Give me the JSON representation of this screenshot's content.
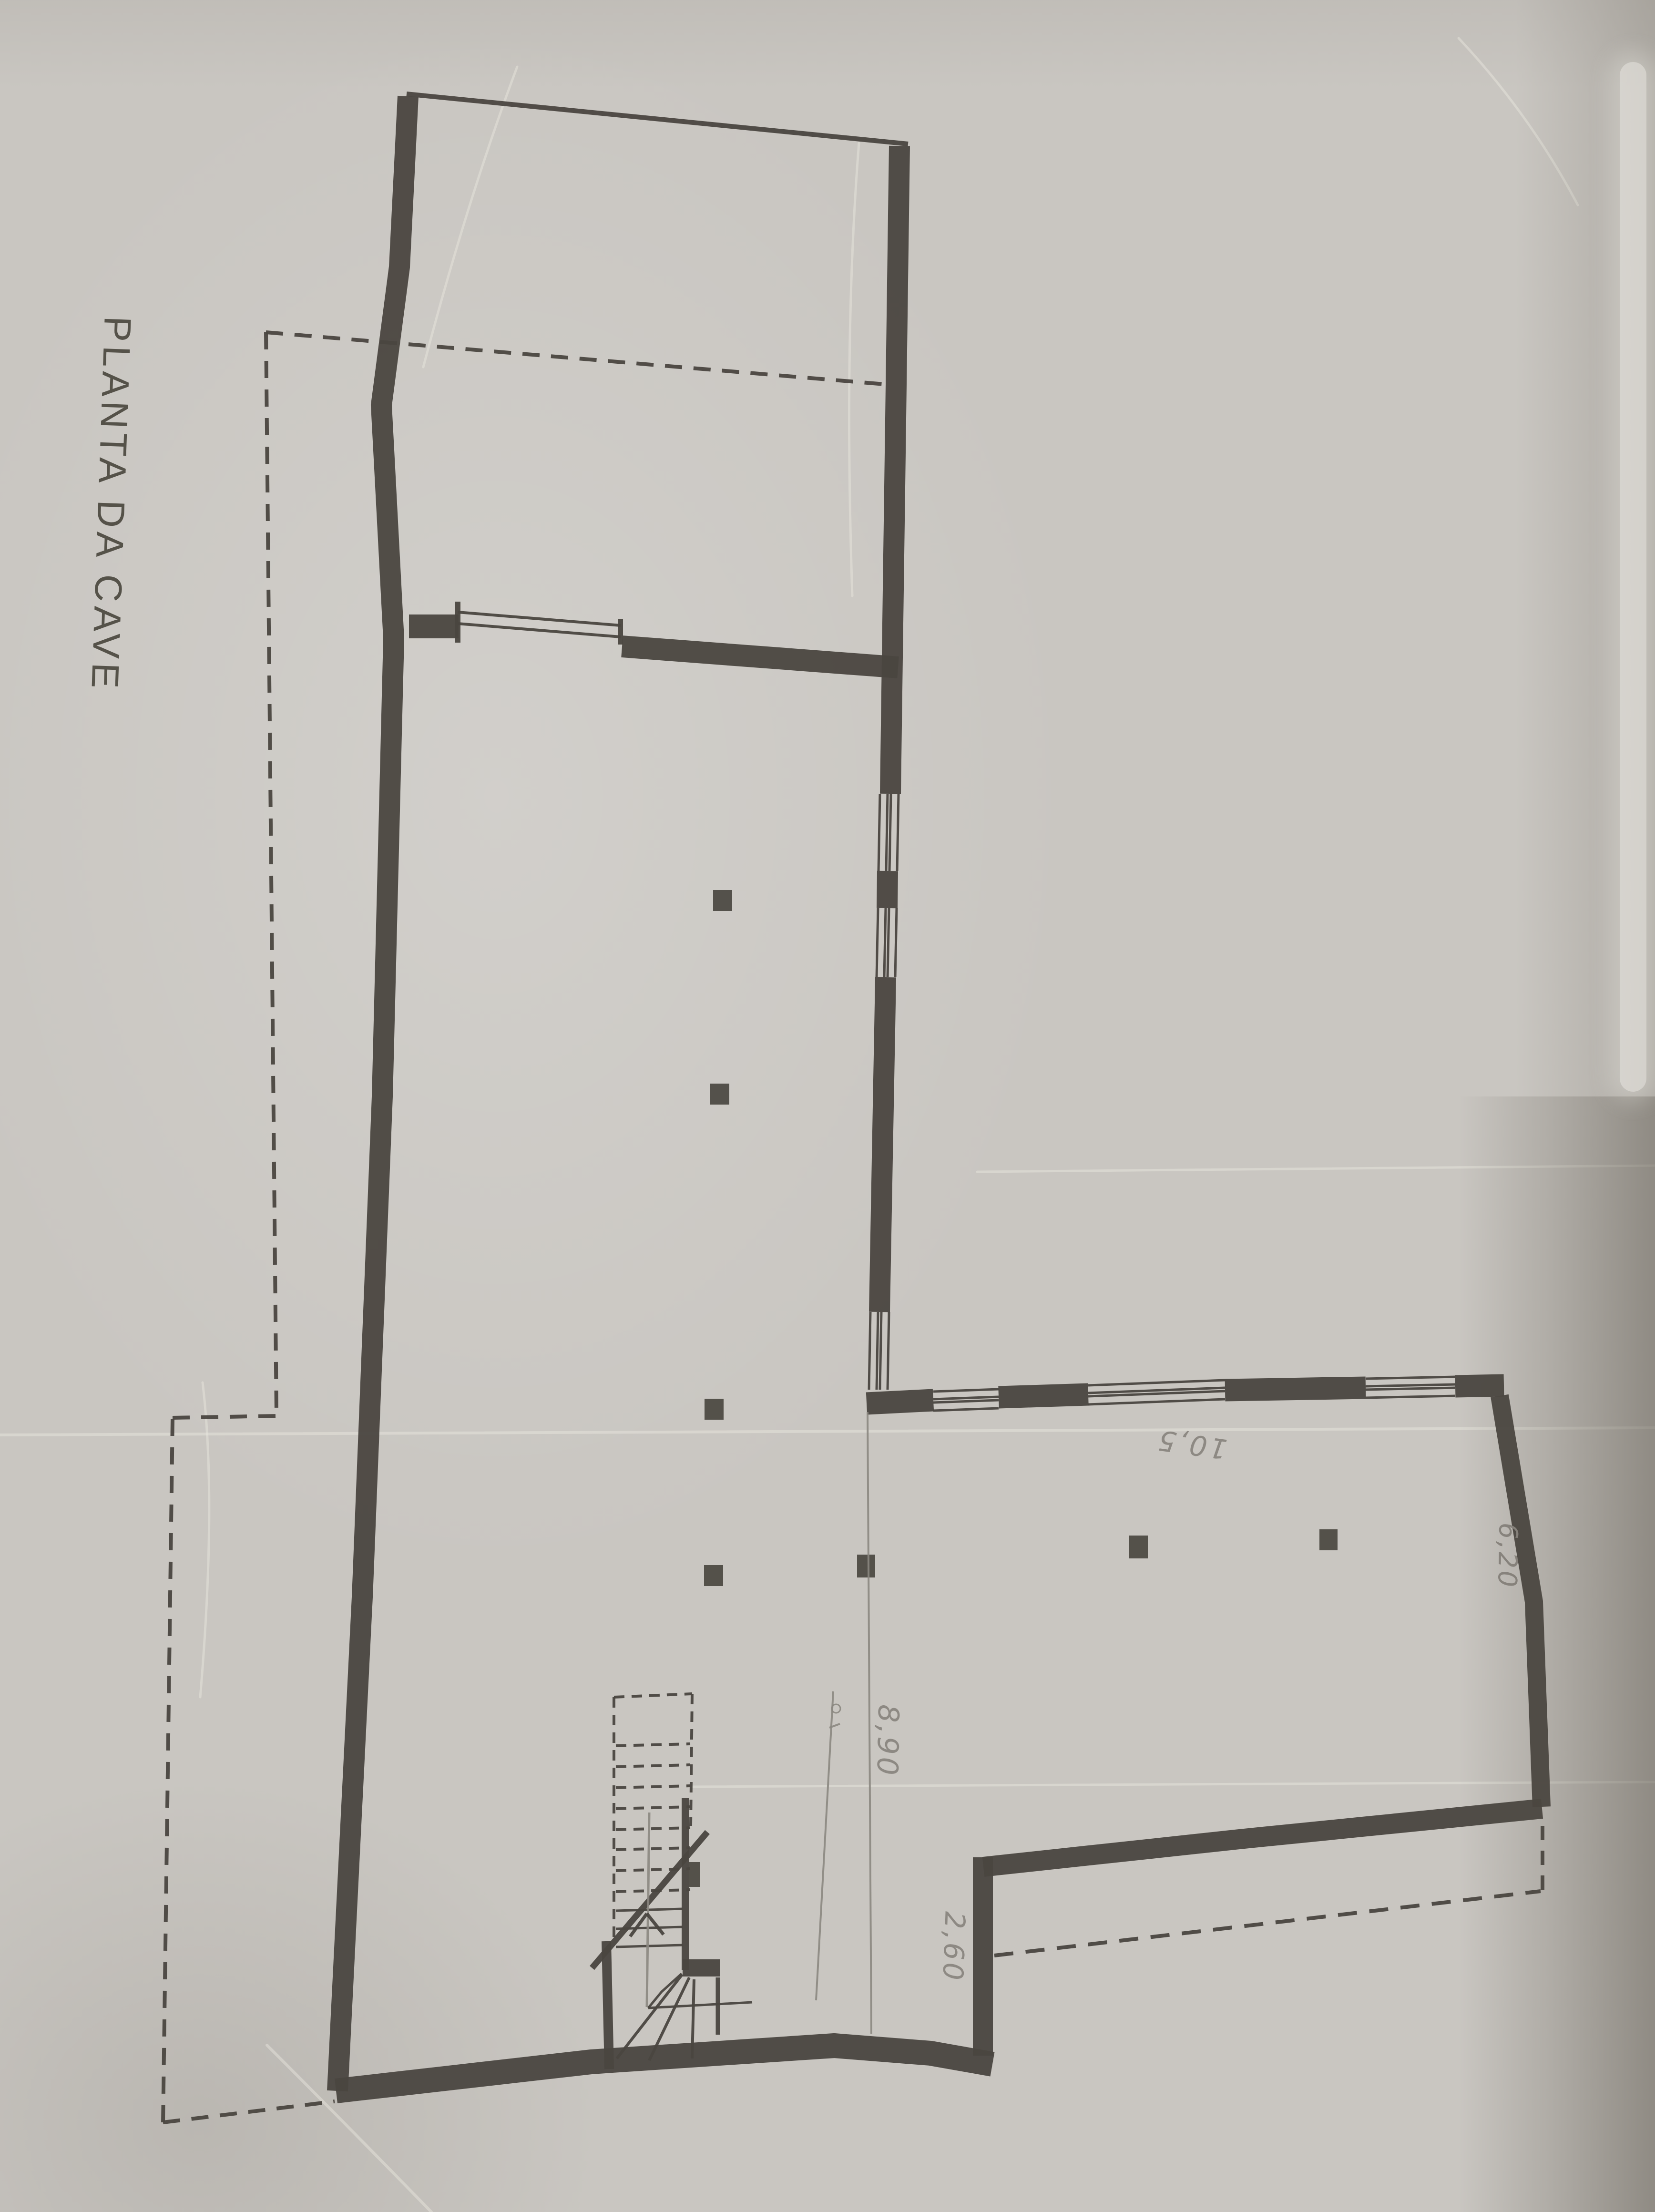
{
  "page": {
    "type": "scanned architectural drawing",
    "sheet": "basement floor plan, pencil on paper"
  },
  "labels": {
    "plan_title": "PLANTA DA CAVE",
    "dim_8_90": "8,90",
    "dim_2_60": "2,60",
    "dim_6_20": "6,20",
    "dim_10_5": "10,5"
  },
  "colors": {
    "paper": "#c9c6c1",
    "ink": "#4a4640",
    "pencil": "#8b8781"
  }
}
